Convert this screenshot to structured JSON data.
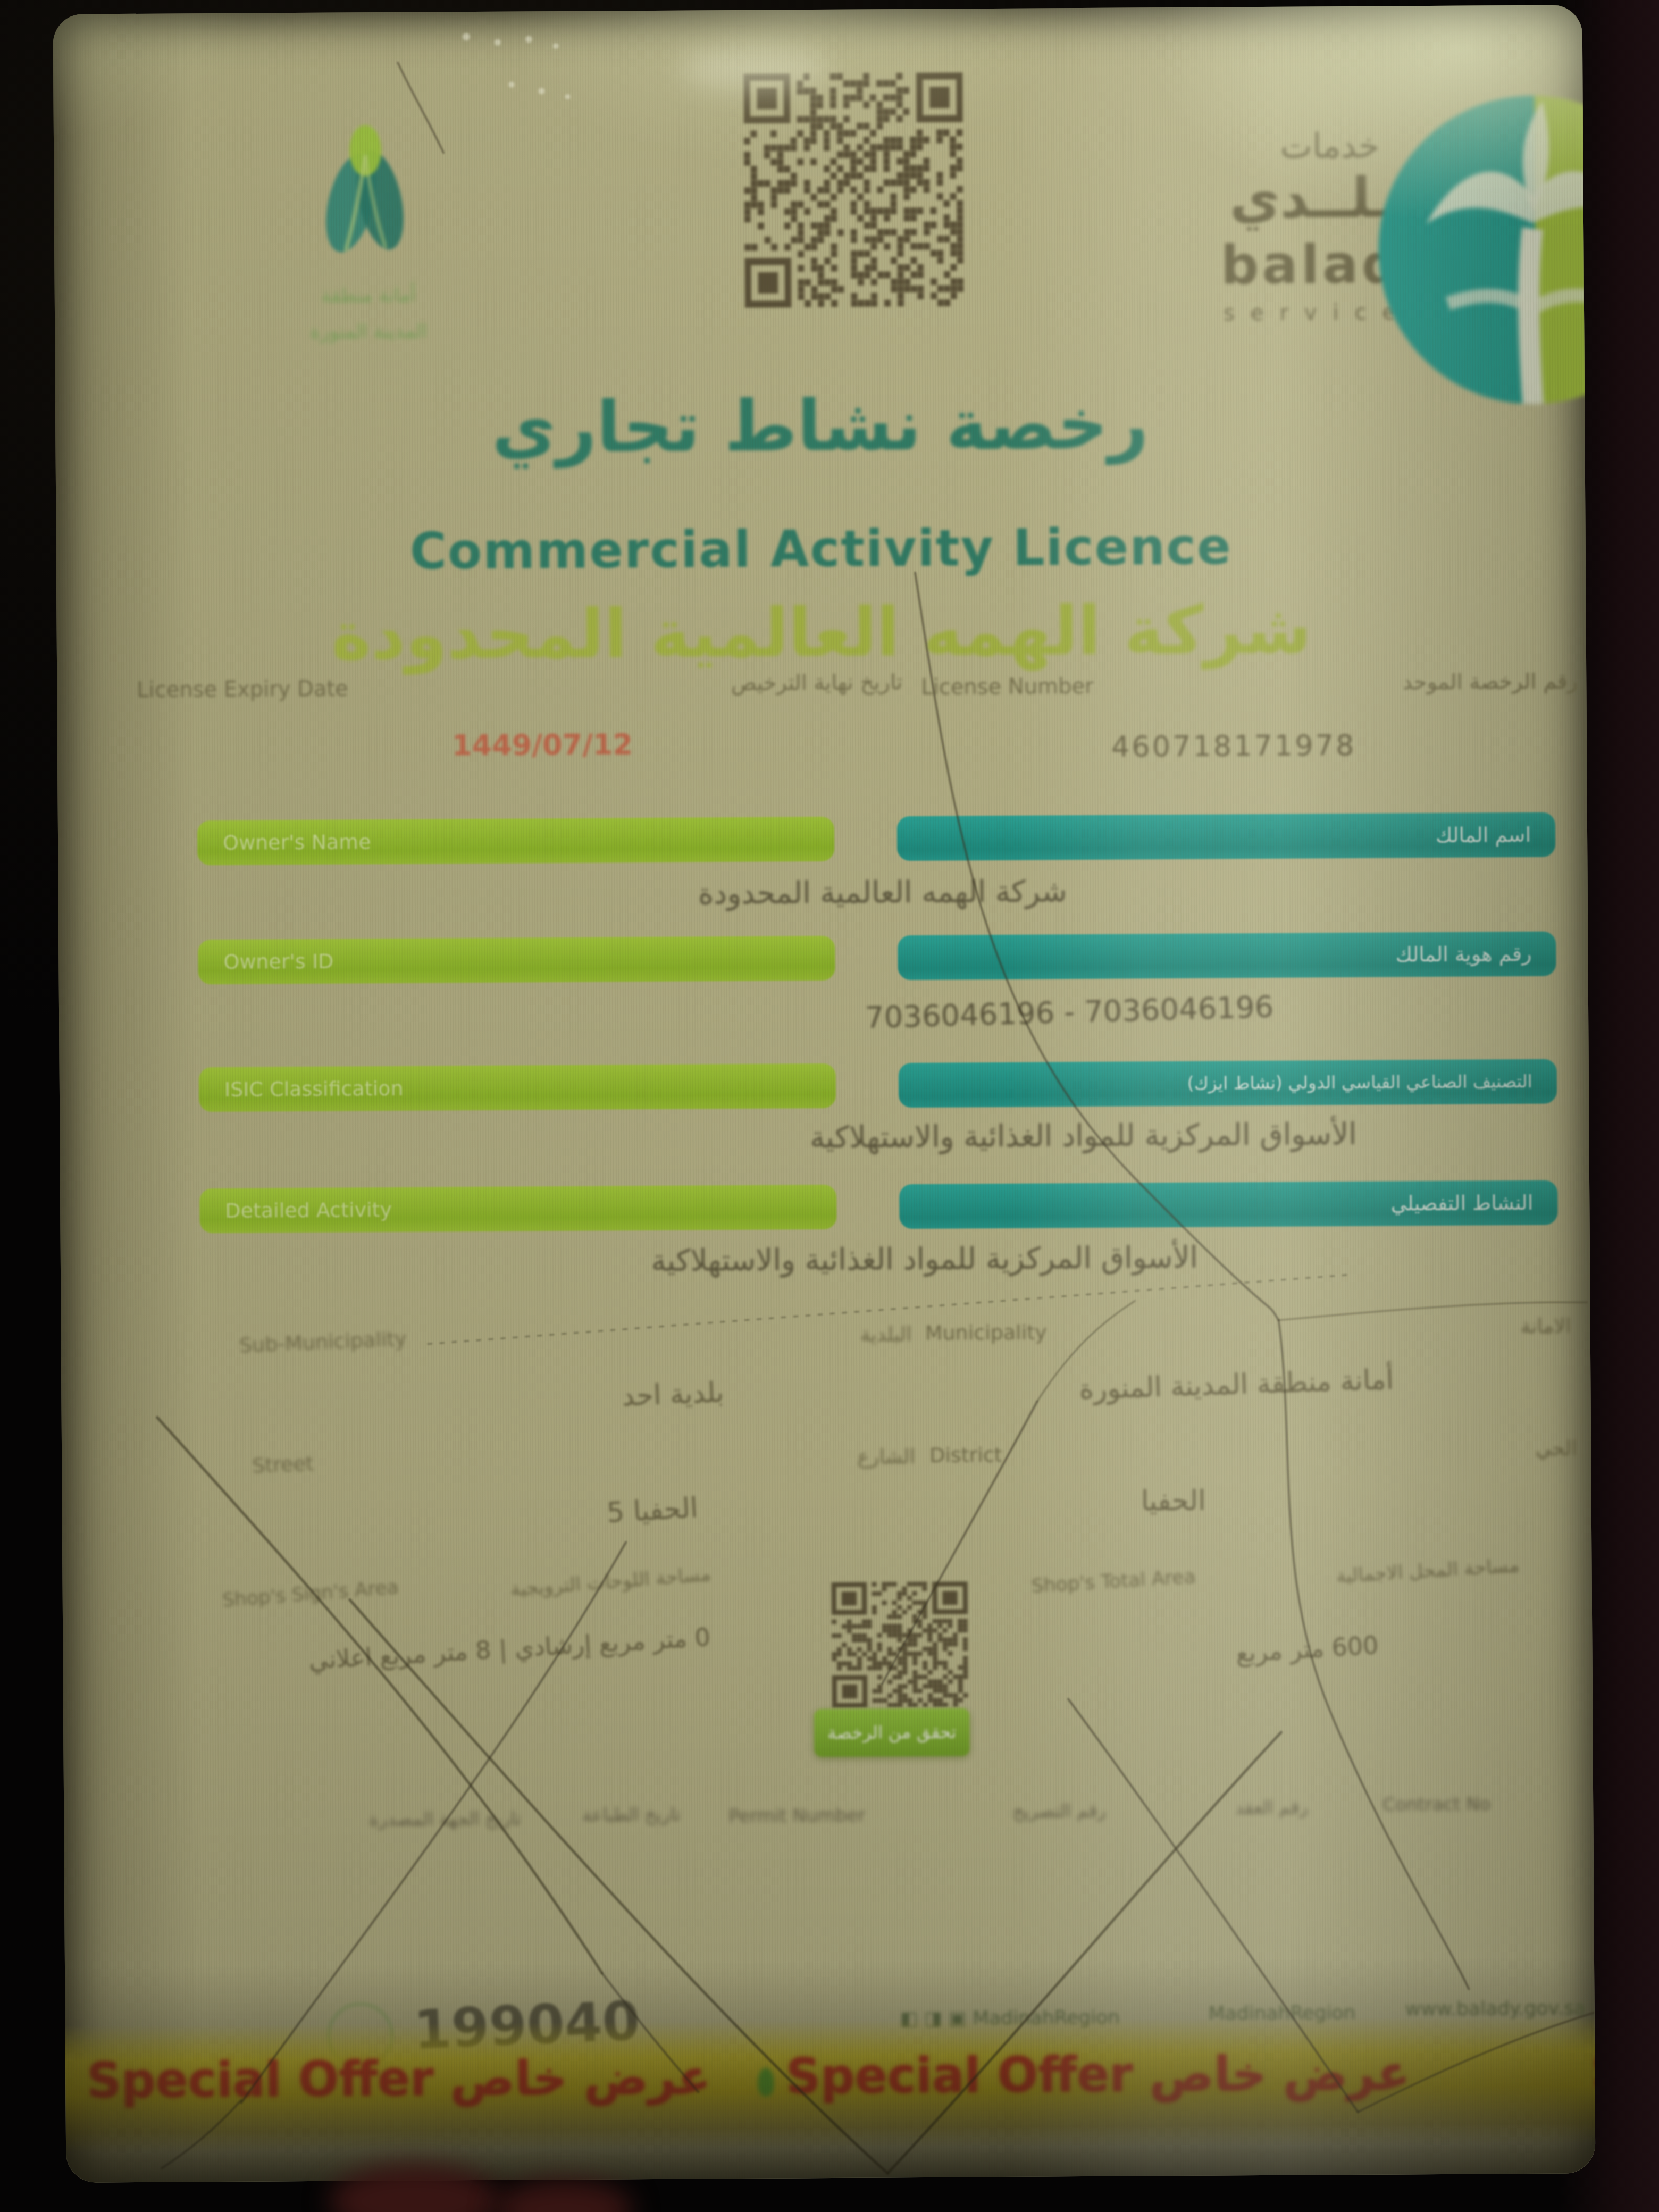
{
  "header": {
    "municipality_caption_line1": "\u0623\u0645\u0627\u0646\u0629 \u0645\u0646\u0637\u0642\u0629",
    "municipality_caption_line2": "\u0627\u0644\u0645\u062f\u064a\u0646\u0629 \u0627\u0644\u0645\u0646\u0648\u0631\u0629",
    "balady_arabic_small": "\u062e\u062f\u0645\u0627\u062a",
    "balady_arabic_big": "\u0628\u0640\u0640\u0644\u0640\u0640\u062f\u064a",
    "balady_latin": "balady",
    "balady_services": "services"
  },
  "title": {
    "arabic": "\u0631\u062e\u0635\u0629 \u0646\u0634\u0627\u0637 \u062a\u062c\u0627\u0631\u064a",
    "english": "Commercial Activity Licence",
    "company": "\u0634\u0631\u0643\u0629 \u0627\u0644\u0647\u0645\u0647 \u0627\u0644\u0639\u0627\u0644\u0645\u064a\u0629 \u0627\u0644\u0645\u062d\u062f\u0648\u062f\u0629"
  },
  "license": {
    "expiry_label_en": "License Expiry Date",
    "expiry_label_ar": "\u062a\u0627\u0631\u064a\u062e \u0646\u0647\u0627\u064a\u0629 \u0627\u0644\u062a\u0631\u062e\u064a\u0635",
    "expiry_value": "1449/07/12",
    "number_label_en": "License Number",
    "number_label_ar": "\u0631\u0642\u0645 \u0627\u0644\u0631\u062e\u0635\u0629 \u0627\u0644\u0645\u0648\u062d\u062f",
    "number_value": "460718171978"
  },
  "fields": [
    {
      "label_en": "Owner's Name",
      "label_ar": "\u0627\u0633\u0645 \u0627\u0644\u0645\u0627\u0644\u0643",
      "value": "\u0634\u0631\u0643\u0629 \u0627\u0644\u0647\u0645\u0647 \u0627\u0644\u0639\u0627\u0644\u0645\u064a\u0629 \u0627\u0644\u0645\u062d\u062f\u0648\u062f\u0629"
    },
    {
      "label_en": "Owner's ID",
      "label_ar": "\u0631\u0642\u0645 \u0647\u0648\u064a\u0629 \u0627\u0644\u0645\u0627\u0644\u0643",
      "value": "7036046196 - 7036046196"
    },
    {
      "label_en": "ISIC Classification",
      "label_ar": "\u0627\u0644\u062a\u0635\u0646\u064a\u0641 \u0627\u0644\u0635\u0646\u0627\u0639\u064a \u0627\u0644\u0642\u064a\u0627\u0633\u064a \u0627\u0644\u062f\u0648\u0644\u064a (\u0646\u0634\u0627\u0637 \u0627\u064a\u0632\u0643)",
      "value": "\u0627\u0644\u0623\u0633\u0648\u0627\u0642 \u0627\u0644\u0645\u0631\u0643\u0632\u064a\u0629 \u0644\u0644\u0645\u0648\u0627\u062f \u0627\u0644\u063a\u0630\u0627\u0626\u064a\u0629 \u0648\u0627\u0644\u0627\u0633\u062a\u0647\u0644\u0627\u0643\u064a\u0629"
    },
    {
      "label_en": "Detailed Activity",
      "label_ar": "\u0627\u0644\u0646\u0634\u0627\u0637 \u0627\u0644\u062a\u0641\u0635\u064a\u0644\u064a",
      "value": "\u0627\u0644\u0623\u0633\u0648\u0627\u0642 \u0627\u0644\u0645\u0631\u0643\u0632\u064a\u0629 \u0644\u0644\u0645\u0648\u0627\u062f \u0627\u0644\u063a\u0630\u0627\u0626\u064a\u0629 \u0648\u0627\u0644\u0627\u0633\u062a\u0647\u0644\u0627\u0643\u064a\u0629"
    }
  ],
  "location": {
    "sub_municipality_label_en": "Sub-Municipality",
    "sub_municipality_label_ar": "\u0627\u0644\u0628\u0644\u062f\u064a\u0629",
    "sub_municipality_value": "\u0628\u0644\u062f\u064a\u0629 \u0627\u062d\u062f",
    "municipality_label_en": "Municipality",
    "municipality_label_ar": "\u0627\u0644\u0627\u0645\u0627\u0646\u0629",
    "municipality_value": "\u0623\u0645\u0627\u0646\u0629 \u0645\u0646\u0637\u0642\u0629 \u0627\u0644\u0645\u062f\u064a\u0646\u0629 \u0627\u0644\u0645\u0646\u0648\u0631\u0629",
    "street_label_en": "Street",
    "street_label_ar": "\u0627\u0644\u0634\u0627\u0631\u0639",
    "street_value": "\u0627\u0644\u062d\u0641\u064a\u0627 5",
    "district_label_en": "District",
    "district_label_ar": "\u0627\u0644\u062d\u064a",
    "district_value": "\u0627\u0644\u062d\u0641\u064a\u0627"
  },
  "area": {
    "signs_label_en": "Shop's Sign's Area",
    "signs_label_ar": "\u0645\u0633\u0627\u062d\u0629 \u0627\u0644\u0644\u0648\u062d\u0627\u062a \u0627\u0644\u062a\u0631\u0648\u064a\u062c\u064a\u0629",
    "signs_value": "0 \u0645\u062a\u0631 \u0645\u0631\u0628\u0639 \u0625\u0631\u0634\u0627\u062f\u064a | 8 \u0645\u062a\u0631 \u0645\u0631\u0628\u0639 \u0627\u0639\u0644\u0627\u0646\u064a",
    "total_label_en": "Shop's Total Area",
    "total_label_ar": "\u0645\u0633\u0627\u062d\u0629 \u0627\u0644\u0645\u062d\u0644 \u0627\u0644\u0627\u062c\u0645\u0627\u0644\u064a\u0629",
    "total_value": "600 \u0645\u062a\u0631 \u0645\u0631\u0628\u0639",
    "qr_button_label": "\u062a\u062d\u0642\u0642 \u0645\u0646 \u0627\u0644\u0631\u062e\u0635\u0629"
  },
  "footer": {
    "faint_labels": {
      "a": "\u062a\u0627\u0631\u064a\u062e \u0627\u0644\u062c\u0647\u0629 \u0627\u0644\u0645\u0635\u062f\u0631\u0629",
      "b": "\u062a\u0627\u0631\u064a\u062e \u0627\u0644\u0637\u0628\u0627\u0639\u0629",
      "c": "Permit Number",
      "d": "\u0631\u0642\u0645 \u0627\u0644\u062a\u0635\u0631\u064a\u062d",
      "e": "\u0631\u0642\u0645 \u0627\u0644\u0639\u0642\u062f",
      "f": "Contract No"
    },
    "big_number": "199040",
    "social_handle": "MadinahRegion",
    "website": "www.balady.gov.sa"
  },
  "banner": {
    "text": "Special Offer \u0639\u0631\u0636 \u062e\u0627\u0635"
  }
}
